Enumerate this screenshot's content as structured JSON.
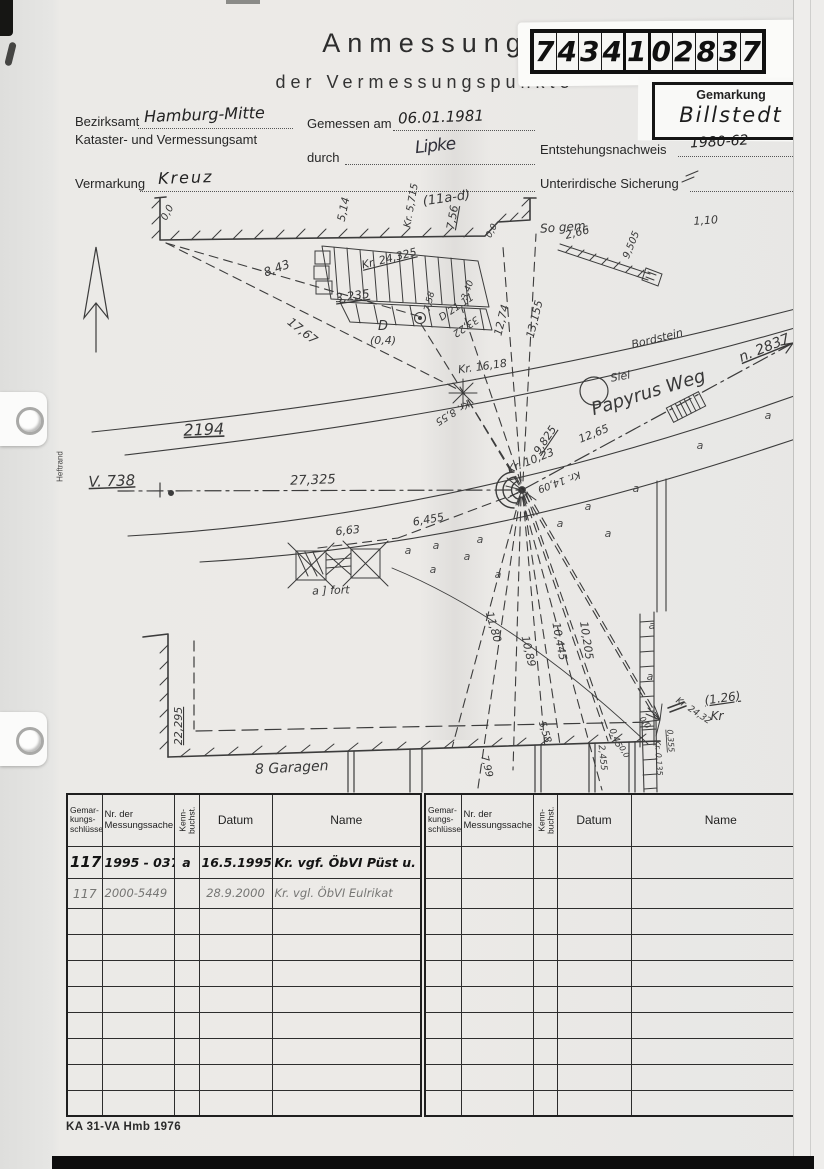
{
  "header": {
    "title_line1": "Anmessung",
    "title_line2": "der Vermessungspunkte",
    "doc_number": "7434102837",
    "gemarkung_label": "Gemarkung",
    "gemarkung_value": "Billstedt"
  },
  "form": {
    "bezirksamt_label": "Bezirksamt",
    "bezirksamt_value": "Hamburg-Mitte",
    "amt_line": "Kataster- und Vermessungsamt",
    "gemessen_label": "Gemessen am",
    "gemessen_value": "06.01.1981",
    "durch_label": "durch",
    "durch_value": "Lipke",
    "entstehung_label": "Entstehungsnachweis",
    "entstehung_value": "1980-62",
    "vermarkung_label": "Vermarkung",
    "vermarkung_value": "Kreuz",
    "sicherung_label": "Unterirdische Sicherung",
    "heftrand_label": "Heftrand"
  },
  "sketch": {
    "labels": [
      {
        "t": "(11a-d)",
        "x": 447,
        "y": 202,
        "r": -8,
        "s": 13
      },
      {
        "t": "0,0",
        "x": 170,
        "y": 214,
        "r": -62,
        "s": 10
      },
      {
        "t": "5,14",
        "x": 347,
        "y": 210,
        "r": -78,
        "s": 11
      },
      {
        "t": "Kr. 5,715",
        "x": 414,
        "y": 206,
        "r": -80,
        "s": 10
      },
      {
        "t": "7,56",
        "x": 456,
        "y": 218,
        "r": -80,
        "s": 11,
        "u": 1
      },
      {
        "t": "0,0",
        "x": 494,
        "y": 232,
        "r": -62,
        "s": 9
      },
      {
        "t": "2,66",
        "x": 578,
        "y": 236,
        "r": -14,
        "s": 11
      },
      {
        "t": "9,505",
        "x": 634,
        "y": 246,
        "r": -68,
        "s": 10
      },
      {
        "t": "1,10",
        "x": 706,
        "y": 224,
        "r": -4,
        "s": 11
      },
      {
        "t": "So gem.",
        "x": 565,
        "y": 231,
        "r": -4,
        "s": 12
      },
      {
        "t": "Kr. 24,325",
        "x": 390,
        "y": 262,
        "r": -14,
        "s": 11,
        "u": 1
      },
      {
        "t": "8,43",
        "x": 278,
        "y": 272,
        "r": -20,
        "s": 12
      },
      {
        "t": "3,235",
        "x": 353,
        "y": 300,
        "r": -8,
        "s": 12,
        "u": 1
      },
      {
        "t": "17,67",
        "x": 300,
        "y": 334,
        "r": 38,
        "s": 12
      },
      {
        "t": "7,58",
        "x": 432,
        "y": 302,
        "r": -76,
        "s": 9
      },
      {
        "t": "3,40",
        "x": 470,
        "y": 291,
        "r": -70,
        "s": 9
      },
      {
        "t": "D 21,11",
        "x": 458,
        "y": 310,
        "r": -34,
        "s": 10
      },
      {
        "t": "33,22",
        "x": 464,
        "y": 324,
        "r": 146,
        "s": 10
      },
      {
        "t": "12,74",
        "x": 505,
        "y": 321,
        "r": -76,
        "s": 11
      },
      {
        "t": "13,155",
        "x": 538,
        "y": 320,
        "r": -76,
        "s": 11
      },
      {
        "t": "D",
        "x": 383,
        "y": 330,
        "r": 0,
        "s": 13
      },
      {
        "t": "(0,4)",
        "x": 383,
        "y": 344,
        "r": 0,
        "s": 11
      },
      {
        "t": "Bordstein",
        "x": 658,
        "y": 342,
        "r": -14,
        "s": 11
      },
      {
        "t": "Kr. 16,18",
        "x": 483,
        "y": 370,
        "r": -8,
        "s": 11
      },
      {
        "t": "Kr. 8,55",
        "x": 451,
        "y": 410,
        "r": 148,
        "s": 10
      },
      {
        "t": "n. 2837",
        "x": 766,
        "y": 352,
        "r": -22,
        "s": 14,
        "u": 1
      },
      {
        "t": "Siel",
        "x": 621,
        "y": 380,
        "r": -10,
        "s": 11
      },
      {
        "t": "Papyrus Weg",
        "x": 650,
        "y": 398,
        "r": -17,
        "s": 18
      },
      {
        "t": "9,825",
        "x": 548,
        "y": 442,
        "r": -56,
        "s": 11,
        "u": 1
      },
      {
        "t": "12,65",
        "x": 595,
        "y": 437,
        "r": -22,
        "s": 11
      },
      {
        "t": "Kr. 10,23",
        "x": 532,
        "y": 464,
        "r": -22,
        "s": 11
      },
      {
        "t": "Kr. 14,09",
        "x": 558,
        "y": 479,
        "r": 160,
        "s": 10
      },
      {
        "t": "2194",
        "x": 204,
        "y": 435,
        "r": -2,
        "s": 16,
        "u": 1
      },
      {
        "t": "V. 738",
        "x": 112,
        "y": 486,
        "r": -2,
        "s": 15,
        "u": 1
      },
      {
        "t": "27,325",
        "x": 313,
        "y": 484,
        "r": -2,
        "s": 13
      },
      {
        "t": "6,63",
        "x": 348,
        "y": 534,
        "r": -6,
        "s": 11
      },
      {
        "t": "6,455",
        "x": 429,
        "y": 523,
        "r": -10,
        "s": 11
      },
      {
        "t": "a ] fort",
        "x": 331,
        "y": 594,
        "r": -2,
        "s": 11
      },
      {
        "t": "11,80",
        "x": 490,
        "y": 628,
        "r": 74,
        "s": 11
      },
      {
        "t": "10,89",
        "x": 525,
        "y": 652,
        "r": 77,
        "s": 11
      },
      {
        "t": "10,445",
        "x": 556,
        "y": 642,
        "r": 79,
        "s": 11
      },
      {
        "t": "10,205",
        "x": 583,
        "y": 641,
        "r": 81,
        "s": 11
      },
      {
        "t": "5,58",
        "x": 542,
        "y": 733,
        "r": 73,
        "s": 10
      },
      {
        "t": "7,99",
        "x": 484,
        "y": 767,
        "r": 76,
        "s": 10
      },
      {
        "t": "2,455",
        "x": 600,
        "y": 758,
        "r": 84,
        "s": 9
      },
      {
        "t": "0,45",
        "x": 613,
        "y": 739,
        "r": 68,
        "s": 9
      },
      {
        "t": "0,0",
        "x": 622,
        "y": 753,
        "r": 60,
        "s": 8
      },
      {
        "t": "0,0",
        "x": 643,
        "y": 724,
        "r": 55,
        "s": 8
      },
      {
        "t": "Kr. 0,135",
        "x": 656,
        "y": 758,
        "r": 86,
        "s": 8
      },
      {
        "t": "0,355",
        "x": 668,
        "y": 741,
        "r": 86,
        "s": 8,
        "u": 1
      },
      {
        "t": "Kr. 24,32",
        "x": 692,
        "y": 713,
        "r": 34,
        "s": 9
      },
      {
        "t": "(1.26)",
        "x": 723,
        "y": 702,
        "r": -8,
        "s": 12,
        "u": 1
      },
      {
        "t": "Kr",
        "x": 717,
        "y": 720,
        "r": 0,
        "s": 12
      },
      {
        "t": "22,295",
        "x": 182,
        "y": 726,
        "r": -90,
        "s": 11,
        "u": 1
      },
      {
        "t": "8 Garagen",
        "x": 292,
        "y": 772,
        "r": -3,
        "s": 14
      }
    ],
    "a_marks": [
      [
        408,
        554
      ],
      [
        436,
        549
      ],
      [
        480,
        543
      ],
      [
        467,
        560
      ],
      [
        433,
        573
      ],
      [
        498,
        578
      ],
      [
        560,
        527
      ],
      [
        588,
        510
      ],
      [
        636,
        492
      ],
      [
        700,
        449
      ],
      [
        768,
        419
      ],
      [
        652,
        629
      ],
      [
        650,
        680
      ],
      [
        608,
        537
      ]
    ]
  },
  "table": {
    "headers": {
      "col_gemarkung": "Gemar-\nkungs-\nschlüssel",
      "col_nr": "Nr. der\nMessungssache",
      "col_kenn": "Kenn-\nbuchst.",
      "col_datum": "Datum",
      "col_name": "Name"
    },
    "left_rows": [
      [
        "117",
        "1995 - 037",
        "a",
        "16.5.1995",
        "Kr. vgf. ÖbVI Püst u. Manack"
      ],
      [
        "117",
        "2000-5449",
        "",
        "28.9.2000",
        "Kr. vgl. ÖbVI Eulrikat"
      ]
    ],
    "right_rows": []
  },
  "footer": {
    "form_id": "KA 31-VA Hmb 1976"
  }
}
